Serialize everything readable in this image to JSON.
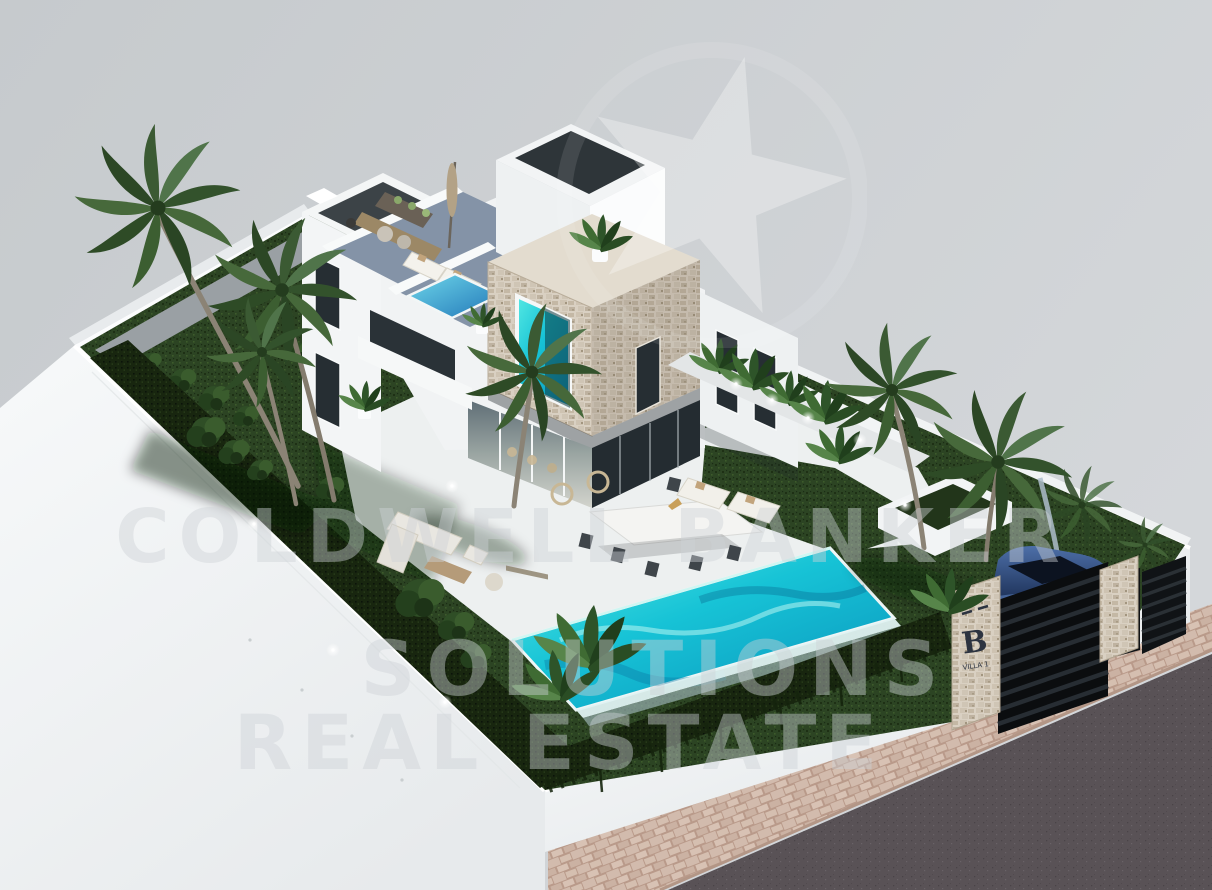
{
  "watermark": {
    "line1": "COLDWELL BANKER",
    "line2": "SOLUTIONS",
    "line3": "REAL ESTATE",
    "star_icon": "star-watermark-icon"
  },
  "entrance_sign": {
    "logo_letter": "B",
    "sub_label": "VILLA 1"
  },
  "palette": {
    "bg_left": "#c6cacd",
    "bg_right": "#d4d7da",
    "lawn": "#2c4423",
    "lawn_dark": "#1b2d13",
    "lawn_light": "#44662f",
    "hedge": "#18260f",
    "terrace": "#edf0f0",
    "wall": "#f7f9fa",
    "wall_shade": "#e7eaec",
    "deck": "#8493a7",
    "pool_light": "#55e9e3",
    "pool_mid": "#17c3d6",
    "pool_deep": "#0a95bd",
    "plunge_light": "#6fd8ea",
    "plunge_deep": "#2176b8",
    "stone_light": "#d9d0c2",
    "stone_dark": "#bfb3a0",
    "glass": "#20292e",
    "road": "#595256",
    "sidewalk": "#d2bbad",
    "car_body": "#16284c",
    "car_highlight": "#4d6fa8",
    "trunk": "#8b8375",
    "frond": "#3b5a33",
    "wall_shadow": "#aebdca"
  }
}
